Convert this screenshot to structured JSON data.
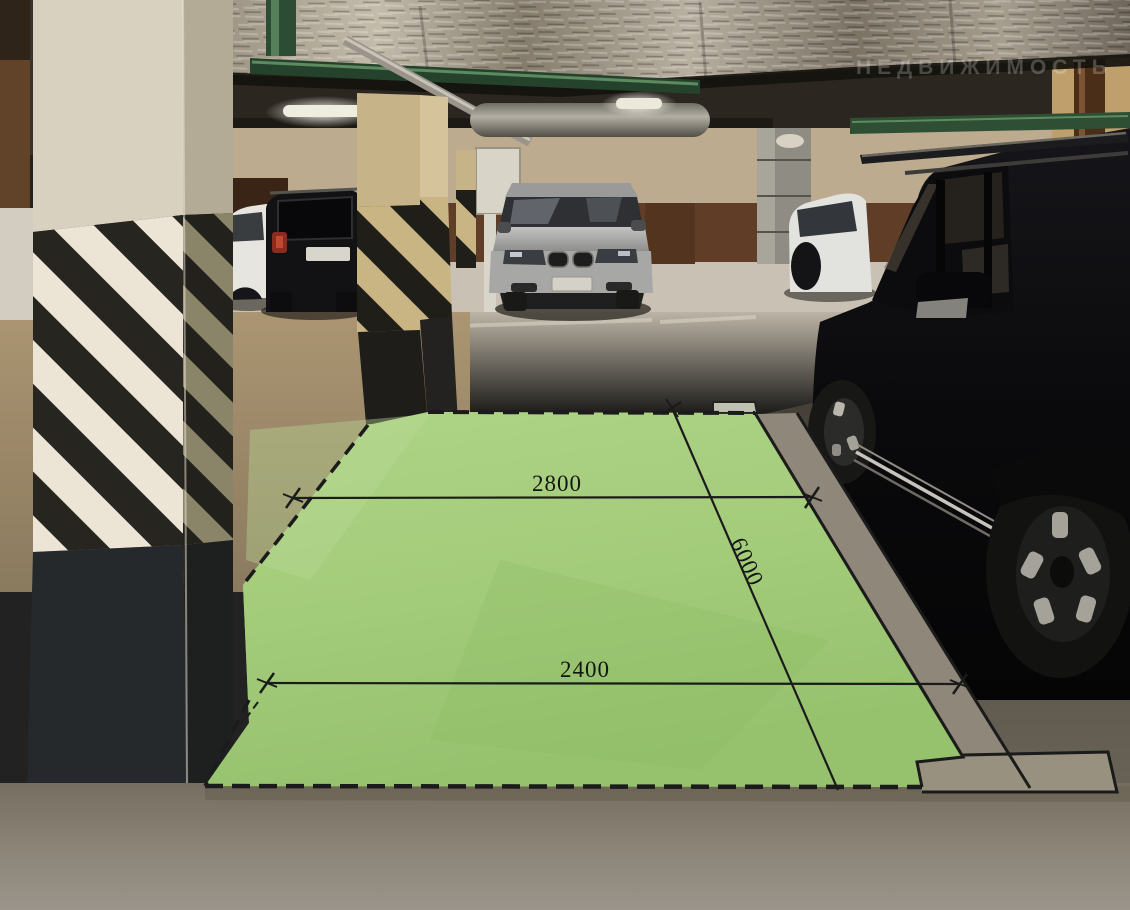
{
  "annotations": {
    "width_label": "2800",
    "depth_label": "6000",
    "entry_width_label": "2400"
  },
  "watermark": {
    "text": "НЕДВИЖИМОСТЬ"
  },
  "colors": {
    "overlay_green": "#a5cd7e",
    "overlay_green_light": "#b3d78d",
    "dimension_line": "#1b1b1b",
    "label_text": "#151515",
    "watermark_text": "#ffffff"
  }
}
